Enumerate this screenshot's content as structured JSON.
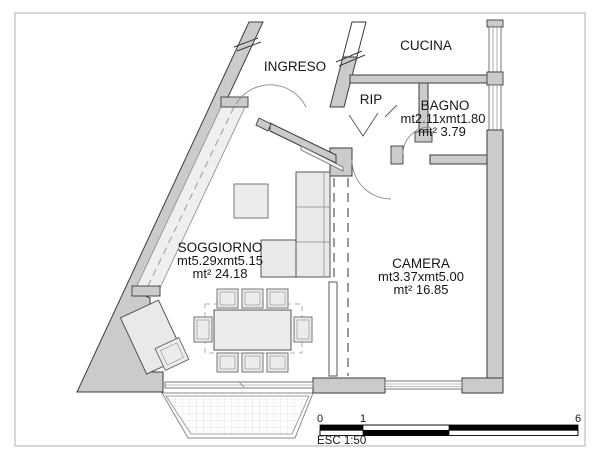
{
  "rooms": {
    "ingreso": {
      "name": "INGRESO"
    },
    "cucina": {
      "name": "CUCINA"
    },
    "rip": {
      "name": "RIP"
    },
    "bagno": {
      "name": "BAGNO",
      "dims": "mt2.11xmt1.80",
      "area": "mt² 3.79"
    },
    "soggiorno": {
      "name": "SOGGIORNO",
      "dims": "mt5.29xmt5.15",
      "area": "mt² 24.18"
    },
    "camera": {
      "name": "CAMERA",
      "dims": "mt3.37xmt5.00",
      "area": "mt² 16.85"
    }
  },
  "scale_bar": {
    "tick_zero": "0",
    "tick_one": "1",
    "tick_six": "6",
    "scale_label": "ESC 1:50"
  },
  "colors": {
    "wall_fill": "#cbcbcb",
    "wall_stroke": "#3b3b3b",
    "furniture_fill": "#ececec",
    "window_fill": "#efefef",
    "frame_border": "#c8c8c8",
    "scale_black": "#000000"
  }
}
